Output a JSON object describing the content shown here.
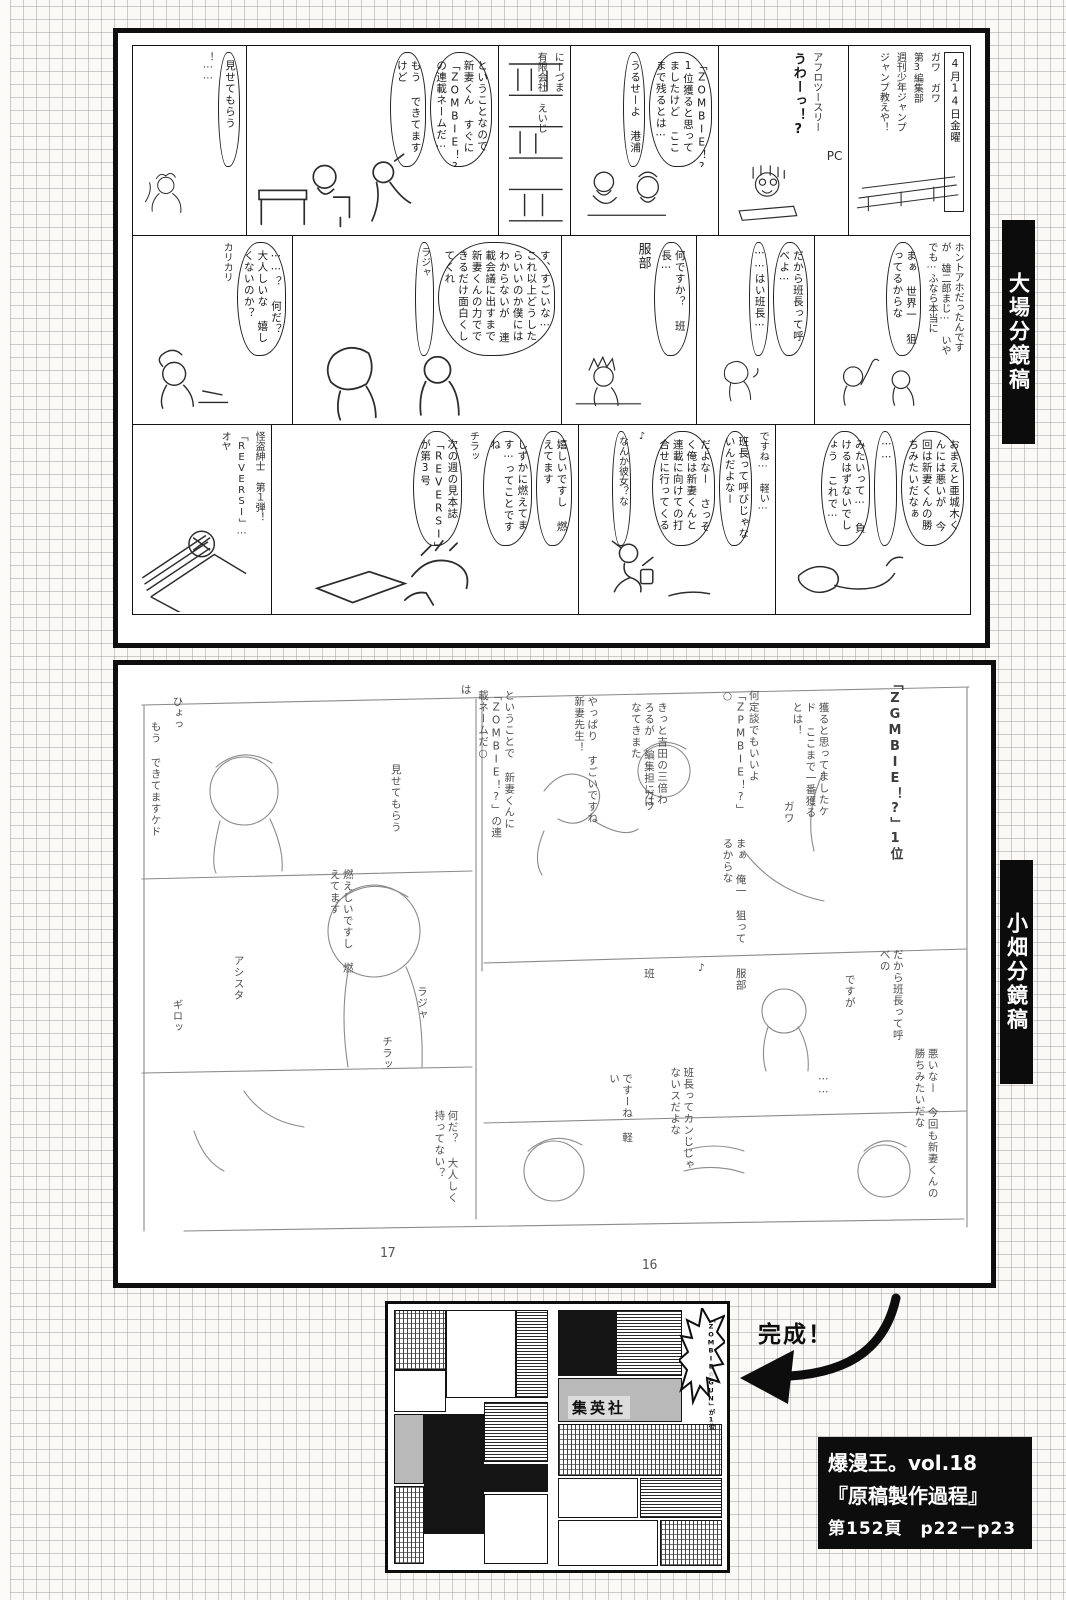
{
  "labels": {
    "ohba": "大場分鏡稿",
    "obata": "小畑分鏡稿"
  },
  "top_panel": {
    "rows": [
      {
        "cells": [
          {
            "texts": [
              "！⋯⋯",
              "見せてもらう"
            ]
          },
          {
            "texts": [
              "もう できてますけど",
              "ということなので 新妻くん すぐに「ZOMBIE！?」の連載ネームだ⋯"
            ]
          },
          {
            "texts": [
              "にーづま",
              "有限会社 えいじ"
            ]
          },
          {
            "texts": [
              "うるせーよ 港浦",
              "「ZOMBIE！?」1位獲ると思ってましたけど ここまで残るとは⋯"
            ]
          },
          {
            "texts": [
              "うわーっ！?",
              "アフロツースリー",
              "PC"
            ]
          },
          {
            "texts": [
              "4月14日金曜",
              "ガワ ガワ",
              "第3編集部",
              "週刊少年ジャンプ",
              "ジャンプ教えや！"
            ]
          }
        ]
      },
      {
        "cells": [
          {
            "texts": [
              "⋯⋯？ 何だ？ 大人しいな 嬉しくないのか？",
              "カリカリ"
            ]
          },
          {
            "texts": [
              "ラジャ",
              "す、すごいな⋯ これ以上どうしたらいいのか僕にはわからないが 連載会議に出すまで新妻くんの力でできるだけ面白くしてくれ"
            ]
          },
          {
            "texts": [
              "服部",
              "何ですか？ 班長⋯"
            ]
          },
          {
            "texts": [
              "⋯⋯はい班長⋯",
              "だから班長って呼べよ⋯"
            ]
          },
          {
            "texts": [
              "まぁ 世界一 狙ってるからな",
              "ホントアホだったんですが 雄二郎まじ⋯ いやでも⋯ふなら本当に"
            ]
          }
        ]
      },
      {
        "cells": [
          {
            "texts": [
              "オヤ",
              "怪盗紳士 第１弾！",
              "「REVERSI」⋯"
            ]
          },
          {
            "texts": [
              "次の週の見本誌 「REVERSI」が第3号",
              "チラッ",
              "しずかに燃えてます⋯ってことですね",
              "嬉しいですし 燃えてます"
            ]
          },
          {
            "texts": [
              "なんか彼女？な",
              "♪",
              "だよなー さっそく俺は新妻くんと連載に向けての打合せに行ってくる",
              "班長って呼びじゃないんだよなー",
              "ですね⋯ 軽い⋯"
            ]
          },
          {
            "texts": [
              "みたいって⋯ 負けるはずないでしょう これで⋯",
              "⋯⋯",
              "おまえと亜城木くんには悪いが 今回は新妻くんの勝ちみたいだなぁ"
            ]
          }
        ]
      }
    ]
  },
  "bottom_panel": {
    "notes": [
      "ひょっ",
      "もう できてますケド",
      "見せてもらう",
      "ということで 新妻くんに「ZOMBIE！?」の連載ネームだ○",
      "は",
      "やっぱり すごいですね 新妻先生！",
      "きっと吉田の三倍わろるが 編集担にはなてきまた",
      "何定談でもいいよ「ZPMBIE！?」○",
      "獲ると思ってましたケド ここまで一番獲るとは！",
      "「ZGMBIE！?」1位",
      "ガワ",
      "ガワ",
      "まぁ 俺一 狙ってるからな",
      "服部",
      "班",
      "♪",
      "だから班長って呼べの",
      "ですが",
      "燃えしいですし 燃えてます",
      "アシスタ",
      "ギロッ",
      "ラジャ",
      "チラッ",
      "班長ってカンじじゃ ないスだよな",
      "ですーね 軽い",
      "何だ？ 大人しく 持ってない？",
      "悪いなー 今回も新妻くんの勝ちみたいだな",
      "⋯⋯"
    ],
    "page_numbers": [
      "17",
      "16"
    ]
  },
  "finished": {
    "kansei": "完成！",
    "publisher": "集英社",
    "burst": "「ZOMBIE☆GUN」が1位"
  },
  "caption": {
    "line1": "爆漫王。vol.18",
    "line2": "『原稿製作過程』",
    "line3": "第152頁　p22－p23"
  },
  "colors": {
    "ink": "#141414",
    "pencil": "#8a8a8a",
    "paper": "#faf9f5",
    "grid": "#828282"
  }
}
